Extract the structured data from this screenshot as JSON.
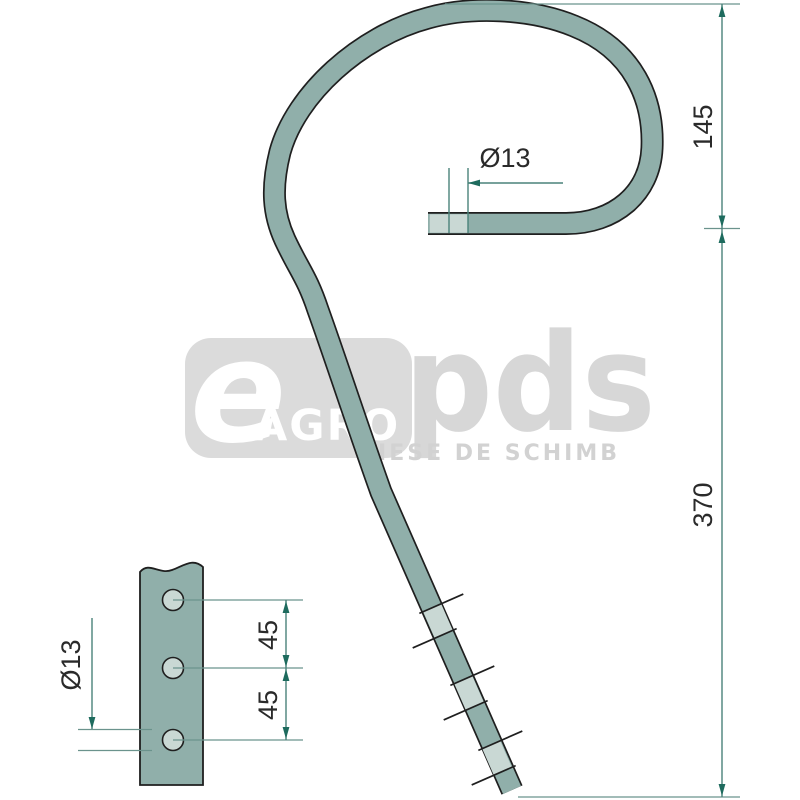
{
  "watermark": {
    "letter": "e",
    "word": "AGRO",
    "brand": "pds",
    "tagline": "PIESE DE SCHIMB"
  },
  "main_view": {
    "dim_hook_height": "145",
    "dim_shaft_length": "370",
    "dim_tip_diameter": "Ø13"
  },
  "detail_view": {
    "dim_hole_spacing_top": "45",
    "dim_hole_spacing_bottom": "45",
    "dim_hole_diameter": "Ø13"
  },
  "colors": {
    "background": "#FFFFFF",
    "tine_fill": "#90AFAA",
    "tine_band": "#C9D8D4",
    "outline": "#1F1F1F",
    "dimension_line": "#4A827A",
    "leader_line": "#6B938D",
    "arrow": "#1E6B5E",
    "dimension_text": "#2A2A2A",
    "watermark_gray": "#DBDBDB",
    "watermark_text": "#FFFFFF"
  }
}
